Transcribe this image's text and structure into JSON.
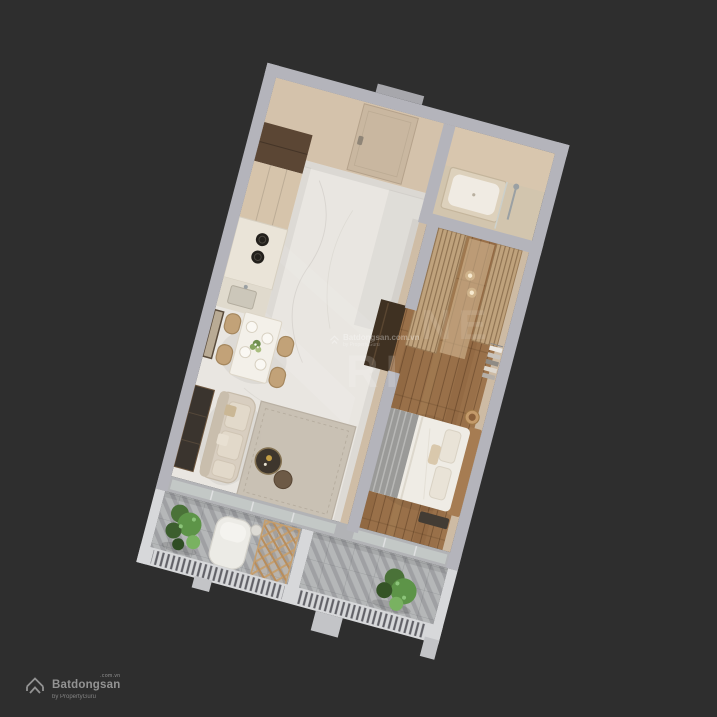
{
  "watermark": {
    "fragment_top": "NE",
    "fragment_bottom": "RI",
    "brand": "Batdongsan.com.vn",
    "byline": "by PropertyGuru"
  },
  "logo": {
    "brand": "Batdongsan",
    "suffix": ".com.vn",
    "byline": "by PropertyGuru"
  },
  "colors": {
    "background": "#2e2e2e",
    "wall_gray": "#b4b4bb",
    "wall_white": "#d7d8da",
    "wall_face": "#d4c2ab",
    "marble": "#e9e6e1",
    "wood_floor": "#997049",
    "tile": "#b5b7b8",
    "bath_floor": "#d2c5ae",
    "cabinet_dark": "#5b4634",
    "cabinet_beige": "#d6c4ab",
    "counter": "#eae4d8",
    "rattan": "#c2a278",
    "sofa": "#d8cec0",
    "rug": "#c7beb1",
    "bed_linen": "#efece5",
    "blanket_gray": "#9a9a98",
    "headboard_wood": "#a67c52",
    "wardrobe_wood": "#bfa27c",
    "plant_green": "#5d9448",
    "trellis_wood": "#c59f6f",
    "logo_gray": "#9c9c9c"
  },
  "scene": {
    "view": "3d-dollhouse-floorplan",
    "rooms": [
      {
        "name": "entry-hall",
        "floor": "marble"
      },
      {
        "name": "bathroom",
        "floor": "beige-tile",
        "fixtures": [
          "bathtub",
          "shower"
        ]
      },
      {
        "name": "kitchen",
        "floor": "marble",
        "fixtures": [
          "tall-cabinets",
          "induction-hob",
          "sink"
        ]
      },
      {
        "name": "dining-area",
        "floor": "marble",
        "fixtures": [
          "dining-table",
          "rattan-chairs",
          "flower-centerpiece",
          "wall-mirror"
        ]
      },
      {
        "name": "living-room",
        "floor": "marble",
        "fixtures": [
          "sofa",
          "rug",
          "nesting-coffee-tables",
          "media-cabinet"
        ]
      },
      {
        "name": "walk-in-wardrobe",
        "floor": "wood",
        "fixtures": [
          "slatted-wardrobes",
          "pendant-lights",
          "clothes-rail"
        ]
      },
      {
        "name": "bedroom",
        "floor": "wood",
        "fixtures": [
          "double-bed",
          "striped-throw",
          "nightstand",
          "bench"
        ]
      },
      {
        "name": "balcony-living",
        "floor": "gray-tile",
        "fixtures": [
          "potted-plants",
          "lounge-chair",
          "wood-trellis",
          "railing"
        ]
      },
      {
        "name": "balcony-bedroom",
        "floor": "gray-tile",
        "fixtures": [
          "potted-plant",
          "railing"
        ]
      }
    ]
  }
}
